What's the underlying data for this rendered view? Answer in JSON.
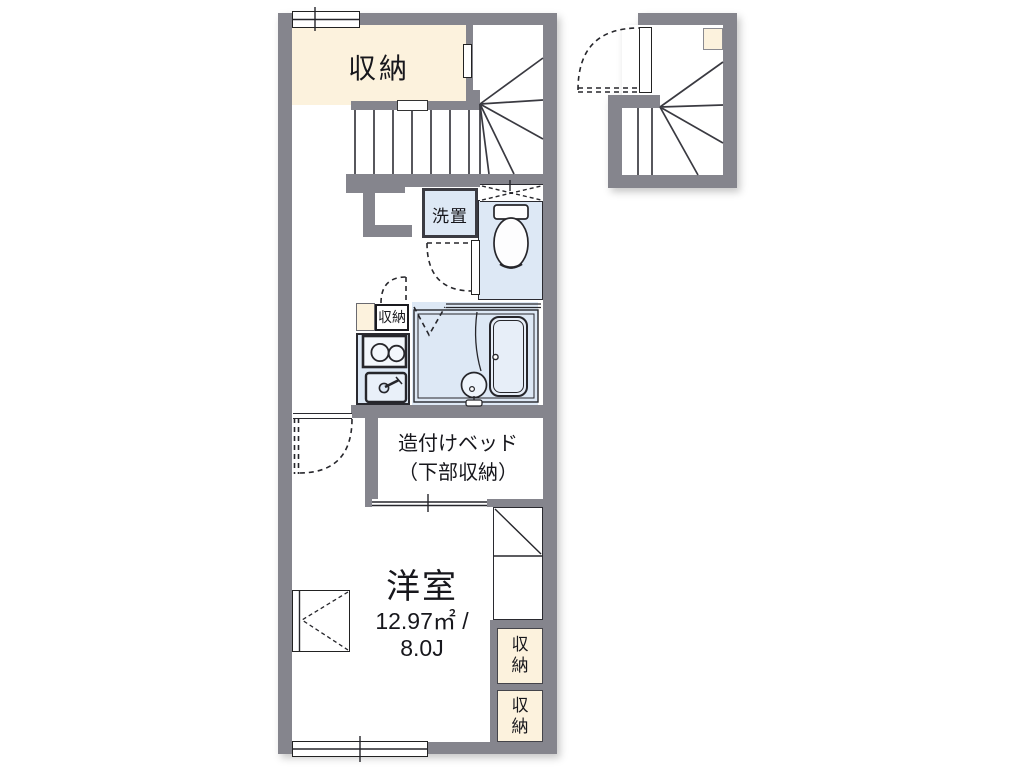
{
  "plan": {
    "title": "floor-plan",
    "labels": {
      "storage_top": "収納",
      "washer": "洗置",
      "kitchen_storage": "収納",
      "bed_line1": "造付けベッド",
      "bed_line2": "（下部収納）",
      "room_name": "洋室",
      "area_m2": "12.97㎡ /",
      "area_jo": "8.0J",
      "closet_upper": "収納",
      "closet_lower": "収納"
    },
    "colors": {
      "wall": "#85858d",
      "storage_fill": "#fcf2dd",
      "wet_area_fill": "#dde8f5",
      "line": "#26262b"
    }
  }
}
